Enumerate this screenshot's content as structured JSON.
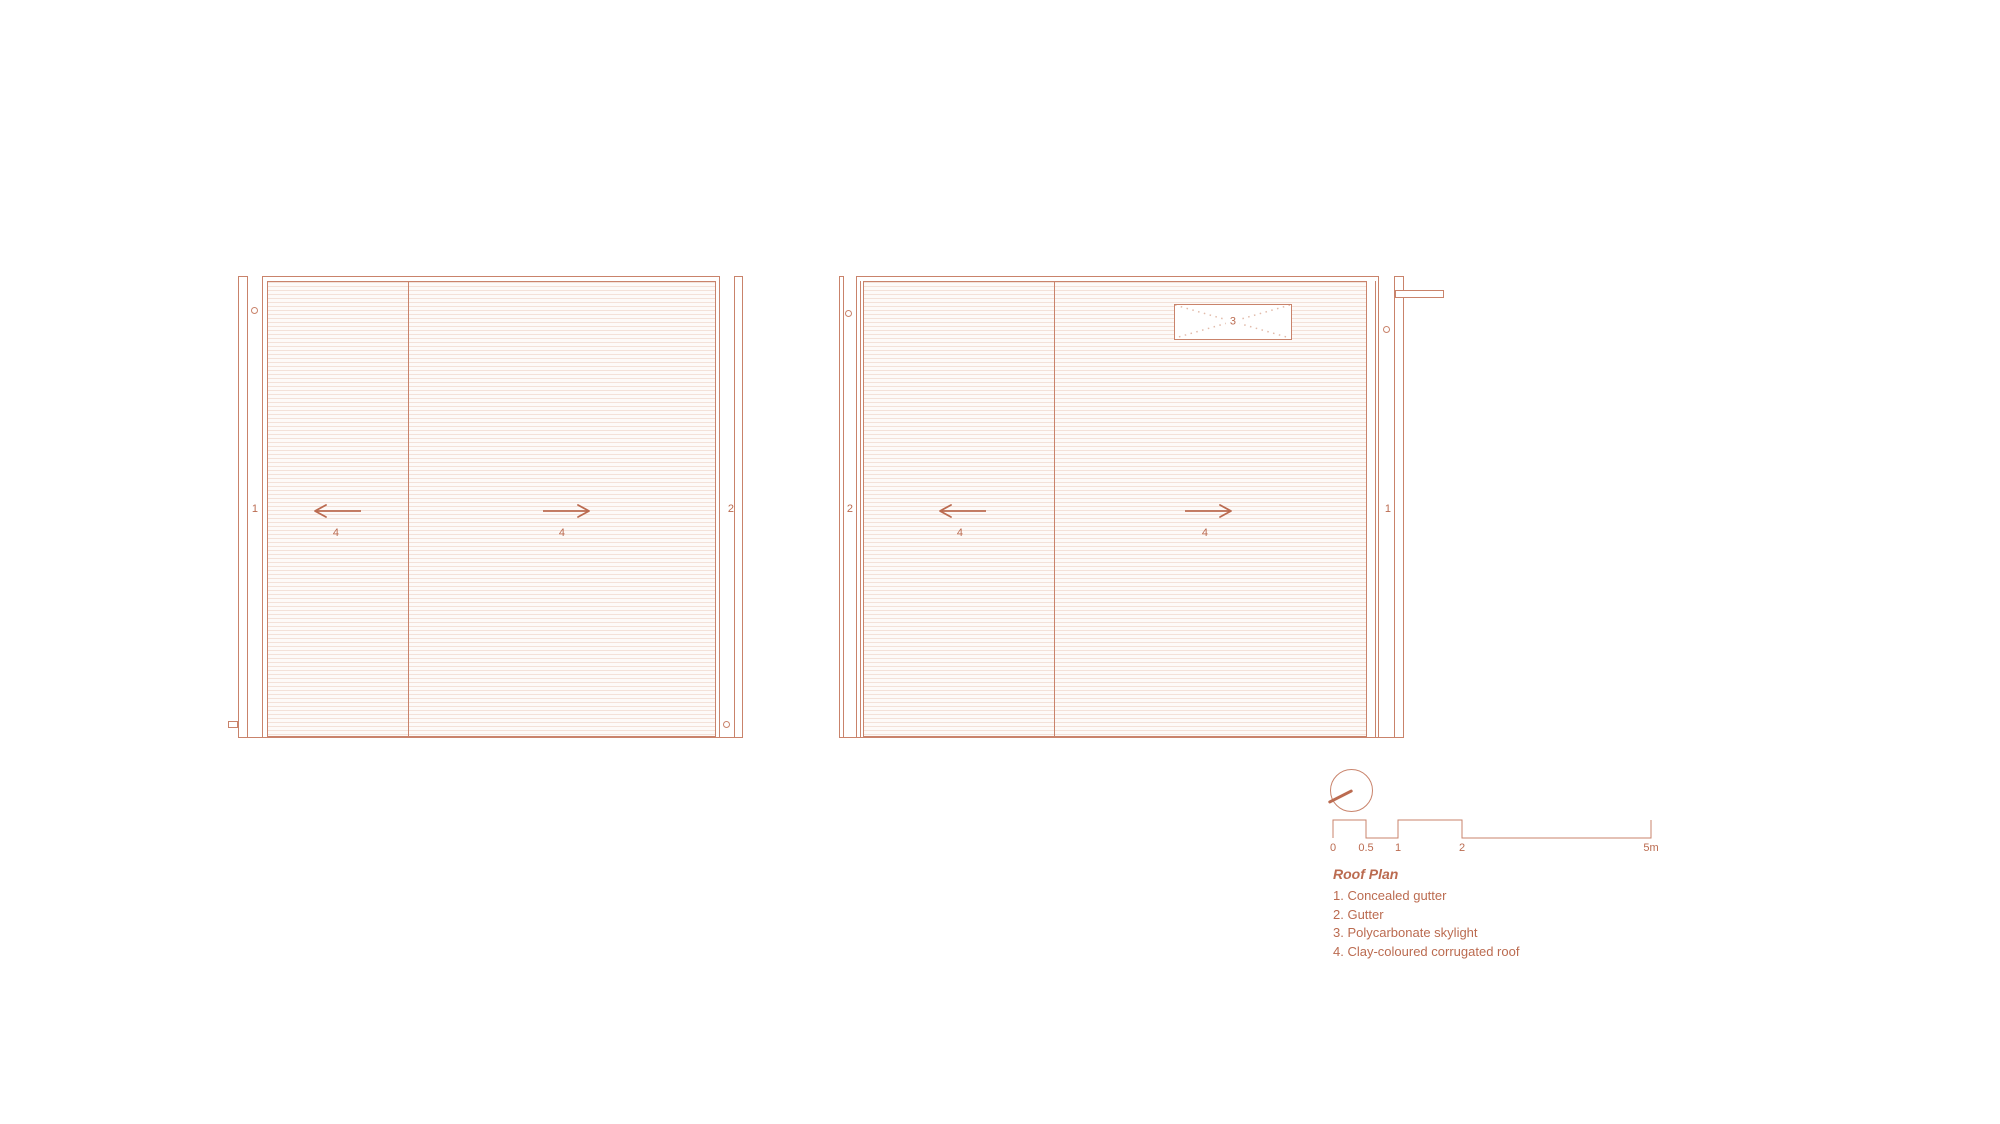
{
  "colors": {
    "line": "#c9836b",
    "accent": "#bb6b50",
    "corrug-line": "#f3e1d8",
    "corrug-bg": "#fdfaf8",
    "dot": "#e2bbaa"
  },
  "drawings": {
    "left": {
      "strip_left_label": "1",
      "panel_a_label": "4",
      "panel_b_label": "4",
      "strip_right_label": "2"
    },
    "right": {
      "strip_left_label": "2",
      "panel_a_label": "4",
      "panel_b_label": "4",
      "skylight_label": "3",
      "strip_right_label": "1"
    }
  },
  "scale_bar": {
    "ticks": [
      "0",
      "0.5",
      "1",
      "2",
      "5m"
    ]
  },
  "legend": {
    "title": "Roof Plan",
    "items": [
      "1. Concealed gutter",
      "2. Gutter",
      "3. Polycarbonate skylight",
      "4. Clay-coloured corrugated roof"
    ]
  }
}
